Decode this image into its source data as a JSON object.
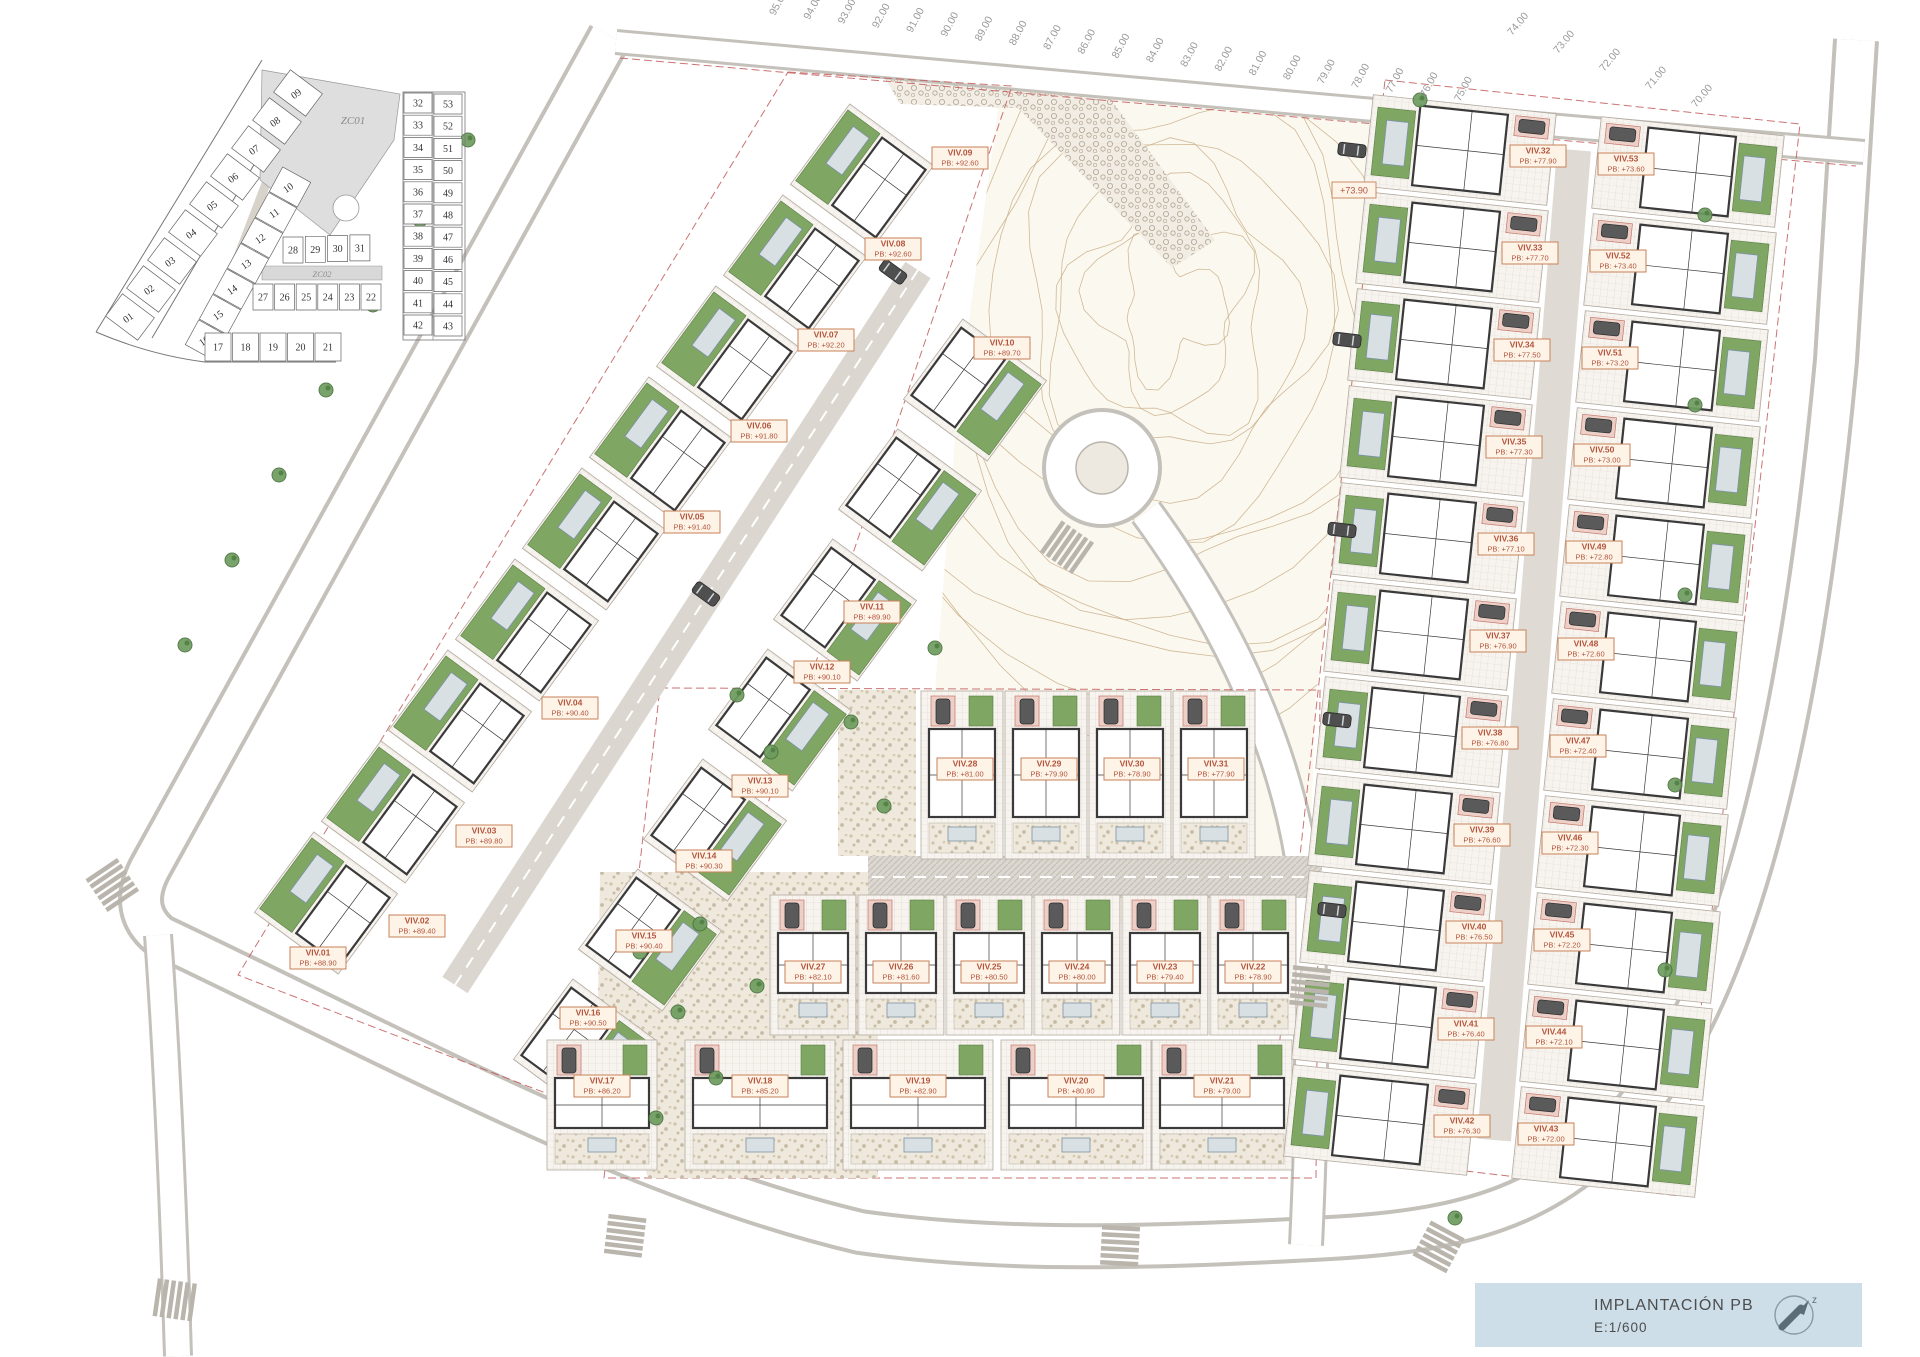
{
  "title_block": {
    "title": "IMPLANTACIÓN PB",
    "scale": "E:1/600",
    "north_icon": "north-arrow"
  },
  "key_plan": {
    "zc01_label": "ZC01",
    "zc02_label": "ZC02",
    "groups": [
      {
        "name": "strip-outer-col",
        "nums": [
          "01",
          "02",
          "03",
          "04",
          "05",
          "06",
          "07",
          "08",
          "09"
        ],
        "x": 130,
        "y": 317,
        "dx": 21,
        "dy": -28,
        "a": [
          8.4,
          -11.2
        ],
        "p": [
          16,
          12
        ],
        "rot": -35
      },
      {
        "name": "strip-inner-col",
        "nums": [
          "10",
          "11",
          "12",
          "13",
          "14",
          "15",
          "16"
        ],
        "x": 290,
        "y": 187,
        "dx": -14,
        "dy": 25.5,
        "a": [
          -6.7,
          12.3
        ],
        "p": [
          14,
          7.7
        ],
        "rot": -35
      },
      {
        "name": "center-row-a",
        "nums": [
          "28",
          "29",
          "30",
          "31"
        ],
        "x": 293,
        "y": 250,
        "dx": 22.3,
        "dy": -0.7,
        "a": [
          10,
          0
        ],
        "p": [
          0,
          13
        ],
        "rot": 0
      },
      {
        "name": "center-row-b",
        "nums": [
          "27",
          "26",
          "25",
          "24",
          "23",
          "22"
        ],
        "x": 263,
        "y": 297,
        "dx": 21.6,
        "dy": 0,
        "a": [
          10,
          0
        ],
        "p": [
          0,
          13
        ],
        "rot": 0
      },
      {
        "name": "center-row-c",
        "nums": [
          "17",
          "18",
          "19",
          "20",
          "21"
        ],
        "x": 218,
        "y": 347,
        "dx": 27.5,
        "dy": 0,
        "a": [
          13,
          0
        ],
        "p": [
          0,
          14
        ],
        "rot": 0
      },
      {
        "name": "right-left-col",
        "nums": [
          "32",
          "33",
          "34",
          "35",
          "36",
          "37",
          "38",
          "39",
          "40",
          "41",
          "42"
        ],
        "x": 418,
        "y": 103,
        "dx": 0,
        "dy": 22.2,
        "a": [
          14,
          0
        ],
        "p": [
          0,
          10
        ],
        "rot": 0
      },
      {
        "name": "right-right-col",
        "nums": [
          "53",
          "52",
          "51",
          "50",
          "49",
          "48",
          "47",
          "46",
          "45",
          "44",
          "43"
        ],
        "x": 448,
        "y": 104,
        "dx": 0,
        "dy": 22.2,
        "a": [
          14,
          0
        ],
        "p": [
          0,
          10
        ],
        "rot": 0
      }
    ]
  },
  "villas": [
    {
      "id": "VIV.01",
      "pb": "+88.90",
      "x": 326,
      "y": 903,
      "rot": 126.4,
      "t": "sl",
      "lx": 318,
      "ly": 958
    },
    {
      "id": "VIV.02",
      "pb": "+89.40",
      "x": 393,
      "y": 812,
      "rot": 126.4,
      "t": "sl",
      "lx": 417,
      "ly": 926
    },
    {
      "id": "VIV.03",
      "pb": "+89.80",
      "x": 460,
      "y": 721,
      "rot": 126.4,
      "t": "sl",
      "lx": 484,
      "ly": 836
    },
    {
      "id": "VIV.04",
      "pb": "+90.40",
      "x": 527,
      "y": 630,
      "rot": 126.4,
      "t": "sl",
      "lx": 570,
      "ly": 708
    },
    {
      "id": "VIV.05",
      "pb": "+91.40",
      "x": 594,
      "y": 539,
      "rot": 126.4,
      "t": "sl",
      "lx": 692,
      "ly": 522
    },
    {
      "id": "VIV.06",
      "pb": "+91.80",
      "x": 661,
      "y": 448,
      "rot": 126.4,
      "t": "sl",
      "lx": 759,
      "ly": 431
    },
    {
      "id": "VIV.07",
      "pb": "+92.20",
      "x": 728,
      "y": 357,
      "rot": 126.4,
      "t": "sl",
      "lx": 826,
      "ly": 340
    },
    {
      "id": "VIV.08",
      "pb": "+92.60",
      "x": 795,
      "y": 266,
      "rot": 126.4,
      "t": "sl",
      "lx": 893,
      "ly": 249
    },
    {
      "id": "VIV.09",
      "pb": "+92.60",
      "x": 862,
      "y": 175,
      "rot": 126.4,
      "t": "sl",
      "lx": 960,
      "ly": 158
    },
    {
      "id": "VIV.10",
      "pb": "+89.70",
      "x": 975,
      "y": 390,
      "rot": 126.4,
      "t": "si",
      "lx": 1002,
      "ly": 348
    },
    {
      "id": "VIV.11",
      "pb": "+89.90",
      "x": 910,
      "y": 500,
      "rot": 126.4,
      "t": "si",
      "lx": 872,
      "ly": 612
    },
    {
      "id": "VIV.12",
      "pb": "+90.10",
      "x": 845,
      "y": 610,
      "rot": 126.4,
      "t": "si",
      "lx": 822,
      "ly": 672
    },
    {
      "id": "VIV.13",
      "pb": "+90.10",
      "x": 780,
      "y": 720,
      "rot": 126.4,
      "t": "si",
      "lx": 760,
      "ly": 786
    },
    {
      "id": "VIV.14",
      "pb": "+90.30",
      "x": 715,
      "y": 830,
      "rot": 126.4,
      "t": "si",
      "lx": 704,
      "ly": 861
    },
    {
      "id": "VIV.15",
      "pb": "+90.40",
      "x": 650,
      "y": 940,
      "rot": 126.4,
      "t": "si",
      "lx": 644,
      "ly": 941
    },
    {
      "id": "VIV.16",
      "pb": "+90.50",
      "x": 585,
      "y": 1050,
      "rot": 126.4,
      "t": "si",
      "lx": 588,
      "ly": 1018
    },
    {
      "id": "VIV.17",
      "pb": "+86.20",
      "x": 602,
      "y": 1105,
      "rot": 0,
      "t": "row",
      "w": 110,
      "h": 130,
      "lx": 602,
      "ly": 1086
    },
    {
      "id": "VIV.18",
      "pb": "+85.20",
      "x": 760,
      "y": 1105,
      "rot": 0,
      "t": "row",
      "w": 150,
      "h": 130,
      "lx": 760,
      "ly": 1086
    },
    {
      "id": "VIV.19",
      "pb": "+82.90",
      "x": 918,
      "y": 1105,
      "rot": 0,
      "t": "row",
      "w": 150,
      "h": 130,
      "lx": 918,
      "ly": 1086
    },
    {
      "id": "VIV.20",
      "pb": "+80.90",
      "x": 1076,
      "y": 1105,
      "rot": 0,
      "t": "row",
      "w": 150,
      "h": 130,
      "lx": 1076,
      "ly": 1086
    },
    {
      "id": "VIV.21",
      "pb": "+79.00",
      "x": 1222,
      "y": 1105,
      "rot": 0,
      "t": "row",
      "w": 140,
      "h": 130,
      "lx": 1222,
      "ly": 1086
    },
    {
      "id": "VIV.22",
      "pb": "+78.90",
      "x": 1253,
      "y": 965,
      "rot": 0,
      "t": "row",
      "w": 86,
      "h": 140,
      "lx": 1253,
      "ly": 972
    },
    {
      "id": "VIV.23",
      "pb": "+79.40",
      "x": 1165,
      "y": 965,
      "rot": 0,
      "t": "row",
      "w": 86,
      "h": 140,
      "lx": 1165,
      "ly": 972
    },
    {
      "id": "VIV.24",
      "pb": "+80.00",
      "x": 1077,
      "y": 965,
      "rot": 0,
      "t": "row",
      "w": 86,
      "h": 140,
      "lx": 1077,
      "ly": 972
    },
    {
      "id": "VIV.25",
      "pb": "+80.50",
      "x": 989,
      "y": 965,
      "rot": 0,
      "t": "row",
      "w": 86,
      "h": 140,
      "lx": 989,
      "ly": 972
    },
    {
      "id": "VIV.26",
      "pb": "+81.60",
      "x": 901,
      "y": 965,
      "rot": 0,
      "t": "row",
      "w": 86,
      "h": 140,
      "lx": 901,
      "ly": 972
    },
    {
      "id": "VIV.27",
      "pb": "+82.10",
      "x": 813,
      "y": 965,
      "rot": 0,
      "t": "row",
      "w": 86,
      "h": 140,
      "lx": 813,
      "ly": 972
    },
    {
      "id": "VIV.28",
      "pb": "+81.00",
      "x": 962,
      "y": 775,
      "rot": 0,
      "t": "row",
      "w": 82,
      "h": 168,
      "lx": 965,
      "ly": 769
    },
    {
      "id": "VIV.29",
      "pb": "+79.90",
      "x": 1046,
      "y": 775,
      "rot": 0,
      "t": "row",
      "w": 82,
      "h": 168,
      "lx": 1049,
      "ly": 769
    },
    {
      "id": "VIV.30",
      "pb": "+78.90",
      "x": 1130,
      "y": 775,
      "rot": 0,
      "t": "row",
      "w": 82,
      "h": 168,
      "lx": 1132,
      "ly": 769
    },
    {
      "id": "VIV.31",
      "pb": "+77.90",
      "x": 1214,
      "y": 775,
      "rot": 0,
      "t": "row",
      "w": 82,
      "h": 168,
      "lx": 1216,
      "ly": 769
    },
    {
      "id": "VIV.32",
      "pb": "+77.90",
      "x": 1460,
      "y": 150,
      "rot": 6,
      "t": "rl",
      "lx": 1538,
      "ly": 156
    },
    {
      "id": "VIV.33",
      "pb": "+77.70",
      "x": 1452,
      "y": 247,
      "rot": 6,
      "t": "rl",
      "lx": 1530,
      "ly": 253
    },
    {
      "id": "VIV.34",
      "pb": "+77.50",
      "x": 1444,
      "y": 344,
      "rot": 6,
      "t": "rl",
      "lx": 1522,
      "ly": 350
    },
    {
      "id": "VIV.35",
      "pb": "+77.30",
      "x": 1436,
      "y": 441,
      "rot": 6,
      "t": "rl",
      "lx": 1514,
      "ly": 447
    },
    {
      "id": "VIV.36",
      "pb": "+77.10",
      "x": 1428,
      "y": 538,
      "rot": 6,
      "t": "rl",
      "lx": 1506,
      "ly": 544
    },
    {
      "id": "VIV.37",
      "pb": "+76.90",
      "x": 1420,
      "y": 635,
      "rot": 6,
      "t": "rl",
      "lx": 1498,
      "ly": 641
    },
    {
      "id": "VIV.38",
      "pb": "+76.80",
      "x": 1412,
      "y": 732,
      "rot": 6,
      "t": "rl",
      "lx": 1490,
      "ly": 738
    },
    {
      "id": "VIV.39",
      "pb": "+76.60",
      "x": 1404,
      "y": 829,
      "rot": 6,
      "t": "rl",
      "lx": 1482,
      "ly": 835
    },
    {
      "id": "VIV.40",
      "pb": "+76.50",
      "x": 1396,
      "y": 926,
      "rot": 6,
      "t": "rl",
      "lx": 1474,
      "ly": 932
    },
    {
      "id": "VIV.41",
      "pb": "+76.40",
      "x": 1388,
      "y": 1023,
      "rot": 6,
      "t": "rl",
      "lx": 1466,
      "ly": 1029
    },
    {
      "id": "VIV.42",
      "pb": "+76.30",
      "x": 1380,
      "y": 1120,
      "rot": 6,
      "t": "rl",
      "lx": 1462,
      "ly": 1126
    },
    {
      "id": "VIV.43",
      "pb": "+72.00",
      "x": 1608,
      "y": 1142,
      "rot": 6,
      "t": "rr",
      "lx": 1546,
      "ly": 1134
    },
    {
      "id": "VIV.44",
      "pb": "+72.10",
      "x": 1616,
      "y": 1045,
      "rot": 6,
      "t": "rr",
      "lx": 1554,
      "ly": 1037
    },
    {
      "id": "VIV.45",
      "pb": "+72.20",
      "x": 1624,
      "y": 948,
      "rot": 6,
      "t": "rr",
      "lx": 1562,
      "ly": 940
    },
    {
      "id": "VIV.46",
      "pb": "+72.30",
      "x": 1632,
      "y": 851,
      "rot": 6,
      "t": "rr",
      "lx": 1570,
      "ly": 843
    },
    {
      "id": "VIV.47",
      "pb": "+72.40",
      "x": 1640,
      "y": 754,
      "rot": 6,
      "t": "rr",
      "lx": 1578,
      "ly": 746
    },
    {
      "id": "VIV.48",
      "pb": "+72.60",
      "x": 1648,
      "y": 657,
      "rot": 6,
      "t": "rr",
      "lx": 1586,
      "ly": 649
    },
    {
      "id": "VIV.49",
      "pb": "+72.80",
      "x": 1656,
      "y": 560,
      "rot": 6,
      "t": "rr",
      "lx": 1594,
      "ly": 552
    },
    {
      "id": "VIV.50",
      "pb": "+73.00",
      "x": 1664,
      "y": 463,
      "rot": 6,
      "t": "rr",
      "lx": 1602,
      "ly": 455
    },
    {
      "id": "VIV.51",
      "pb": "+73.20",
      "x": 1672,
      "y": 366,
      "rot": 6,
      "t": "rr",
      "lx": 1610,
      "ly": 358
    },
    {
      "id": "VIV.52",
      "pb": "+73.40",
      "x": 1680,
      "y": 269,
      "rot": 6,
      "t": "rr",
      "lx": 1618,
      "ly": 261
    },
    {
      "id": "VIV.53",
      "pb": "+73.60",
      "x": 1688,
      "y": 172,
      "rot": 6,
      "t": "rr",
      "lx": 1626,
      "ly": 164
    }
  ],
  "grades_top": {
    "values": [
      "95.00",
      "94.00",
      "93.00",
      "92.00",
      "91.00",
      "90.00",
      "89.00",
      "88.00",
      "87.00",
      "86.00",
      "85.00",
      "84.00",
      "83.00",
      "82.00",
      "81.00",
      "80.00",
      "79.00",
      "78.00",
      "77.00",
      "76.00",
      "75.00"
    ],
    "x": 775,
    "y": 16,
    "dx": 34.25,
    "dy": 4.3,
    "rot": -62
  },
  "grades_right": {
    "values": [
      "74.00",
      "73.00",
      "72.00",
      "71.00",
      "70.00"
    ],
    "x": 1512,
    "y": 36,
    "dx": 46,
    "dy": 18,
    "rot": -50
  },
  "spot_elevations": [
    {
      "t": "+73.90",
      "x": 1354,
      "y": 190
    }
  ],
  "zebras": [
    {
      "x": 113,
      "y": 886,
      "r": 56
    },
    {
      "x": 176,
      "y": 1300,
      "r": 8
    },
    {
      "x": 625,
      "y": 1237,
      "r": 97
    },
    {
      "x": 1120,
      "y": 1247,
      "r": 93
    },
    {
      "x": 1438,
      "y": 1248,
      "r": 118
    },
    {
      "x": 1310,
      "y": 988,
      "r": 96
    },
    {
      "x": 1068,
      "y": 548,
      "r": 35
    }
  ],
  "cars": [
    {
      "x": 1352,
      "y": 150,
      "r": 97
    },
    {
      "x": 1347,
      "y": 340,
      "r": 97
    },
    {
      "x": 1342,
      "y": 530,
      "r": 97
    },
    {
      "x": 1337,
      "y": 720,
      "r": 97
    },
    {
      "x": 1332,
      "y": 910,
      "r": 97
    },
    {
      "x": 893,
      "y": 272,
      "r": 126
    },
    {
      "x": 706,
      "y": 594,
      "r": 126
    }
  ],
  "trees": [
    [
      185,
      645
    ],
    [
      232,
      560
    ],
    [
      279,
      475
    ],
    [
      326,
      390
    ],
    [
      373,
      305
    ],
    [
      420,
      220
    ],
    [
      468,
      140
    ],
    [
      640,
      952
    ],
    [
      678,
      1012
    ],
    [
      716,
      1078
    ],
    [
      656,
      1118
    ],
    [
      757,
      986
    ],
    [
      700,
      924
    ],
    [
      851,
      722
    ],
    [
      884,
      806
    ],
    [
      737,
      695
    ],
    [
      771,
      752
    ],
    [
      935,
      648
    ],
    [
      1705,
      215
    ],
    [
      1695,
      405
    ],
    [
      1685,
      595
    ],
    [
      1675,
      785
    ],
    [
      1665,
      970
    ],
    [
      1420,
      100
    ],
    [
      1455,
      1218
    ]
  ],
  "colors": {
    "label_text": "#b3543c",
    "label_bg": "#fdf3e7",
    "label_border": "#c8825a",
    "lawn": "#7fa662",
    "lawn_edge": "#5d7f47",
    "pool": "#d9e0e4",
    "pool_edge": "#7d93a0",
    "walls": "#3a3a3a",
    "road_edge": "#c4c0ba",
    "contour": "#c9ae85",
    "titleblock_bg": "#cddee8",
    "red_dash": "#c25b5b",
    "tree": "#6d9c5f",
    "tree_edge": "#4c7340",
    "pad": "#eccfc7",
    "pad_edge": "#c4766a",
    "grade_text": "#9a9a9a"
  }
}
